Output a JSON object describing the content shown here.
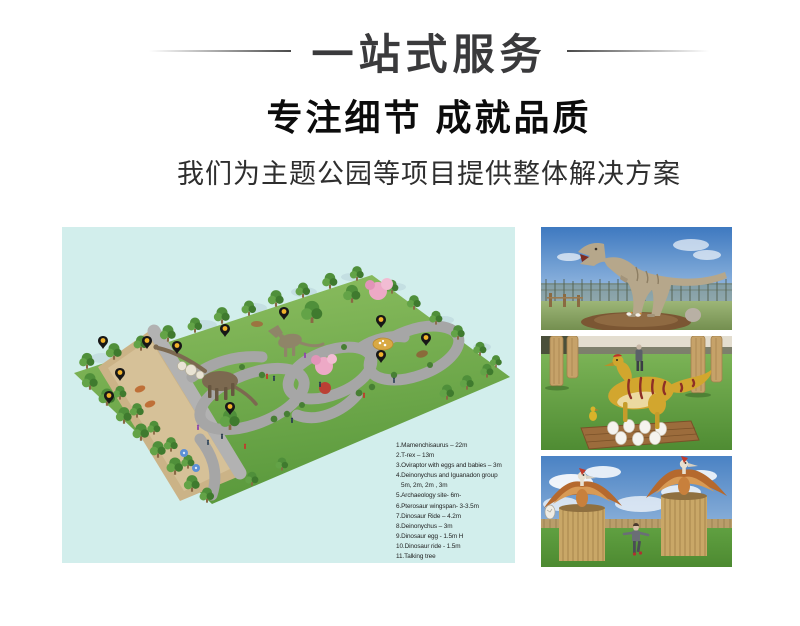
{
  "header": {
    "title": "一站式服务",
    "subtitle": "专注细节 成就品质",
    "description": "我们为主题公园等项目提供整体解决方案"
  },
  "map": {
    "legend": [
      "1.Mamenchisaurus – 22m",
      "2.T-rex – 13m",
      "3.Oviraptor with eggs and babies – 3m",
      "4.Deinonychus and Iguanadon group",
      "5m, 2m, 2m , 3m",
      "5.Archaeology site- 6m-",
      "6.Pterosaur wingspan- 3-3.5m",
      "7.Dinosaur Ride – 4.2m",
      "8.Deinonychus – 3m",
      "9.Dinosaur egg - 1.5m H",
      "10.Dinosaur ride - 1.5m",
      "11.Talking tree"
    ]
  },
  "colors": {
    "heading_text": "#3a3a3c",
    "subtitle_text": "#0c0c0c",
    "map_background": "#d2eeec",
    "pin_body": "#171717",
    "pin_dot": "#f0b32b",
    "grass_green": "#6fae4a",
    "path_gray": "#a6a6a6",
    "sand_tan": "#cbb387",
    "blossom_pink": "#eda9c6",
    "sky_blue": "#4a82c4"
  }
}
